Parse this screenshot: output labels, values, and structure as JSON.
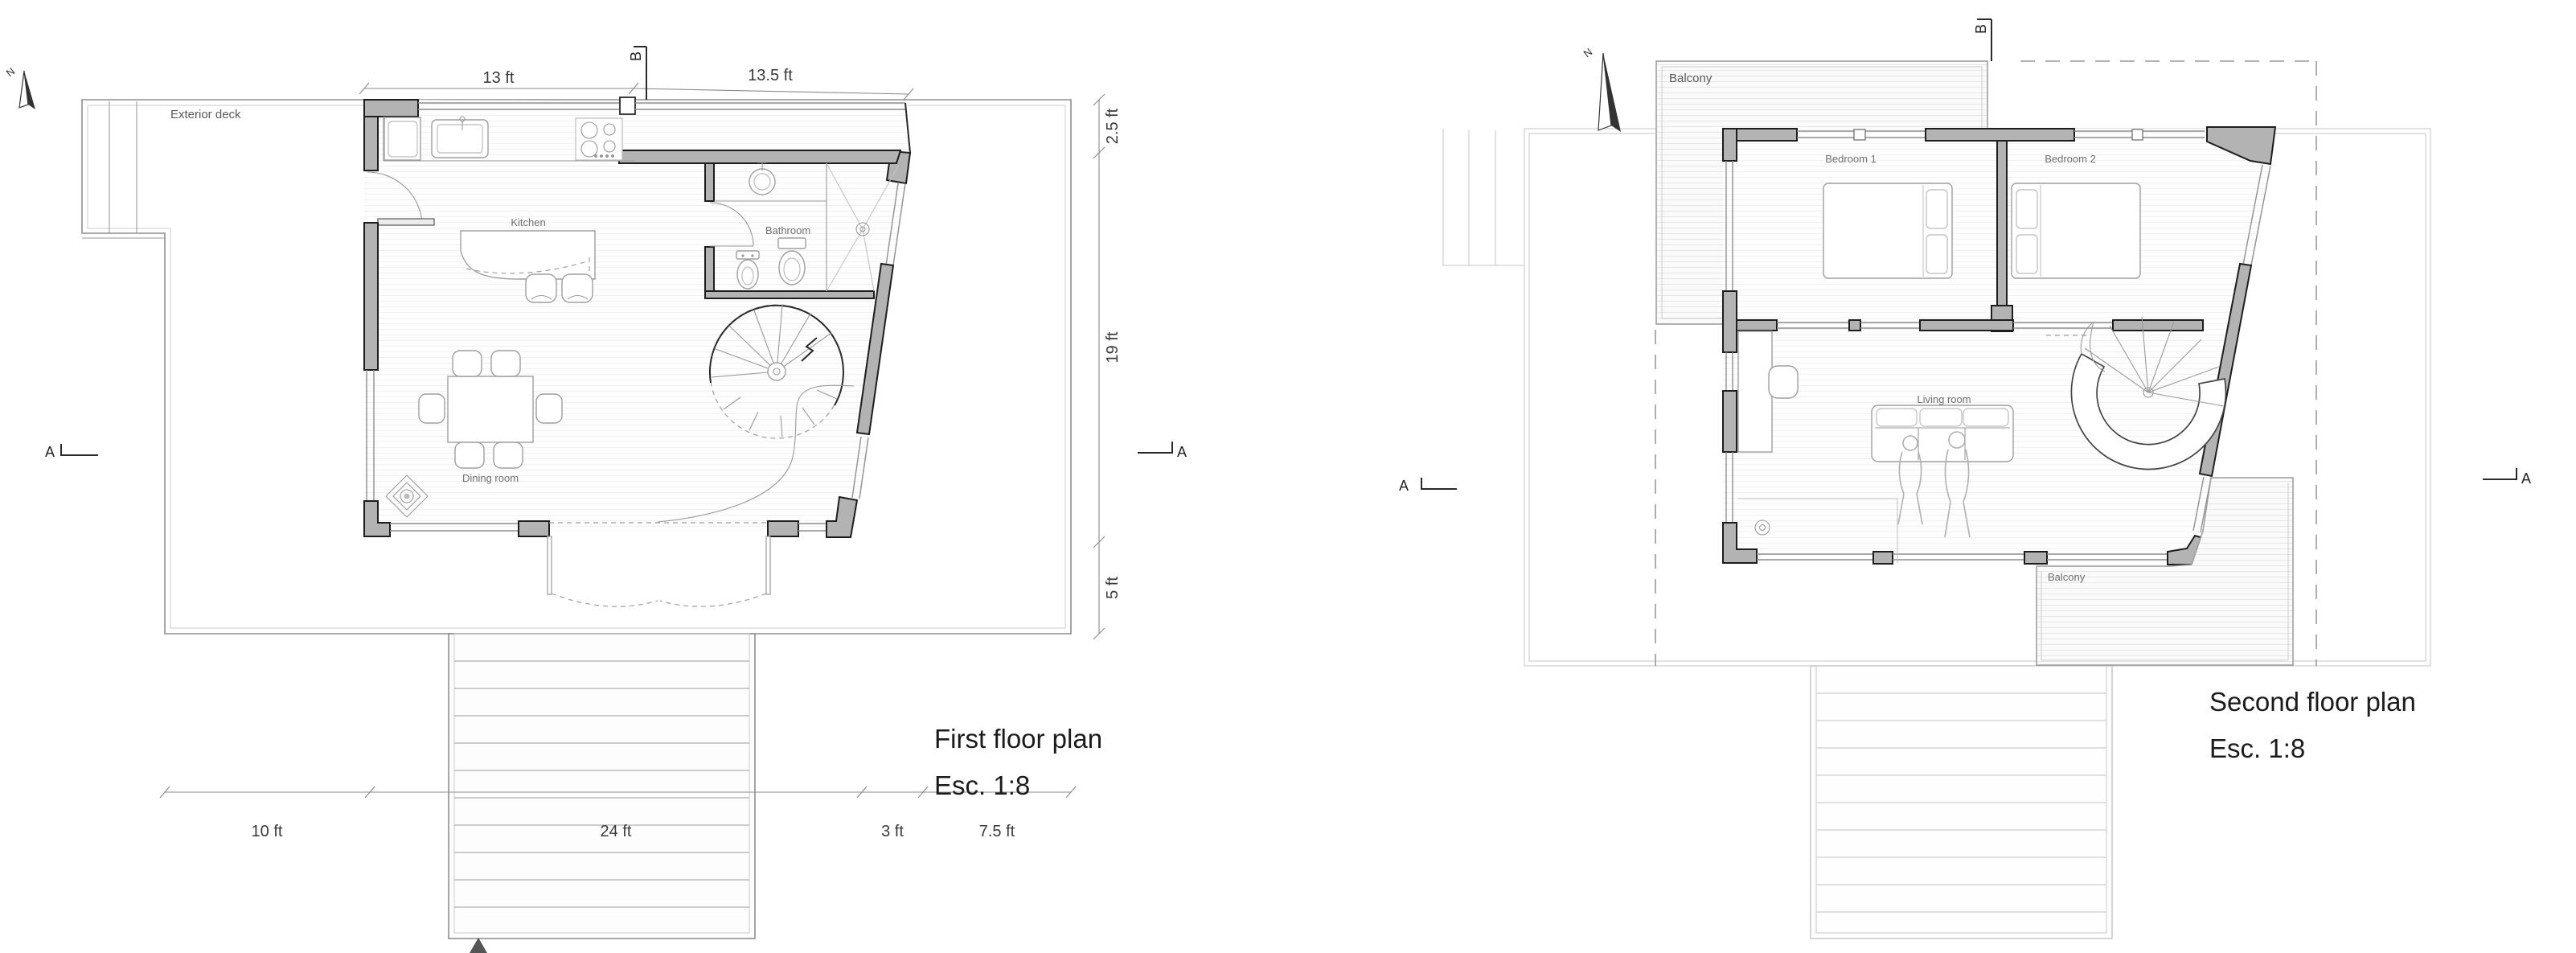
{
  "document": {
    "type": "architectural-floor-plans",
    "sheet_background": "#ffffff"
  },
  "colors": {
    "wall_fill": "#b3b3b3",
    "wall_line": "#1d1d1d",
    "deck_hatch": "#e6e6e6",
    "floor_hatch": "#f0f0f0",
    "ghost_line": "#cfcfcf",
    "label_text": "#6f6f6f",
    "title_text": "#1b1b1b"
  },
  "plan1": {
    "title": "First floor plan",
    "scale": "Esc. 1:8",
    "labels": {
      "deck": "Exterior deck",
      "kitchen": "Kitchen",
      "bathroom": "Bathroom",
      "dining": "Dining room"
    },
    "dims": {
      "top_left": "13 ft",
      "top_right": "13.5 ft",
      "right_top": "2.5 ft",
      "right_mid": "19 ft",
      "right_bottom": "5 ft",
      "bottom_1": "10 ft",
      "bottom_2": "24 ft",
      "bottom_3": "3 ft",
      "bottom_4": "7.5 ft"
    },
    "markers": {
      "section_a": "A",
      "section_b": "B",
      "north": "N"
    }
  },
  "plan2": {
    "title": "Second floor plan",
    "scale": "Esc. 1:8",
    "labels": {
      "balcony_top": "Balcony",
      "bedroom1": "Bedroom 1",
      "bedroom2": "Bedroom 2",
      "living": "Living room",
      "balcony_bottom": "Balcony"
    },
    "markers": {
      "section_a": "A",
      "section_b": "B",
      "north": "N"
    }
  }
}
